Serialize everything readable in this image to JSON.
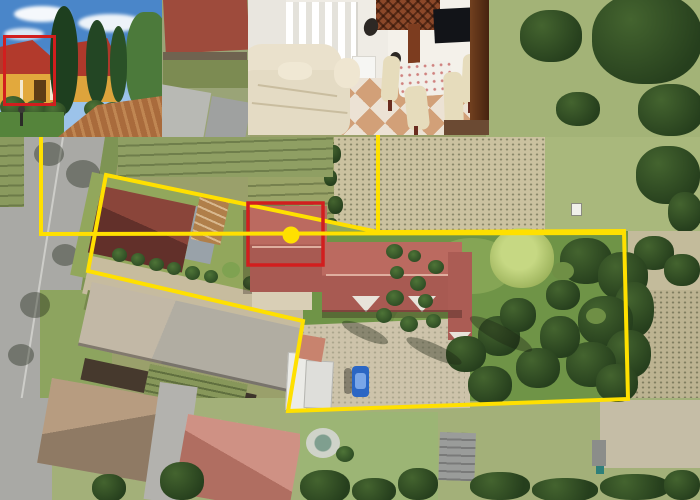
{
  "scene": {
    "kind": "aerial-property-listing-photo",
    "visible_elements": [
      "aerial map of parcels",
      "yellow property boundary outline",
      "red highlight rectangle on subject house",
      "yellow location dot",
      "exterior photo inset",
      "interior photo inset",
      "blue parked car",
      "rear garden with trees",
      "crop field rows",
      "street with trees"
    ]
  },
  "annotations": {
    "yellow": "#FFE000",
    "red": "#D21E1E",
    "property_boundary": {
      "points": [
        [
          106,
          175
        ],
        [
          378,
          232
        ],
        [
          624,
          231
        ],
        [
          628,
          399
        ],
        [
          288,
          411
        ],
        [
          303,
          321
        ],
        [
          88,
          271
        ]
      ]
    },
    "callout_exterior": {
      "points": [
        [
          41,
          137
        ],
        [
          41,
          234
        ],
        [
          624,
          233
        ]
      ]
    },
    "callout_interior": {
      "points": [
        [
          378,
          133
        ],
        [
          378,
          232
        ]
      ]
    },
    "highlight_rect_map": {
      "x": 248,
      "y": 203,
      "width": 75,
      "height": 62
    },
    "highlight_rect_inset": {
      "x": 3,
      "y": 35,
      "width": 47,
      "height": 65
    },
    "marker_dot": {
      "cx": 291,
      "cy": 235,
      "r": 8.5
    }
  },
  "insets": {
    "exterior": {
      "x": 0,
      "y": 0,
      "width": 162,
      "height": 137,
      "subject": "yellow house with red tile roof, cypress trees, brick driveway"
    },
    "interior": {
      "x": 248,
      "y": 0,
      "width": 241,
      "height": 135,
      "subject": "living room: cream corner sofa, dining set, wall TV, checkered tile floor"
    }
  },
  "map": {
    "car_color": "#2A66C4",
    "subject_roof_color": "#B4635A",
    "garden_green": "#6F9447",
    "field_tan": "#CBC2A0"
  }
}
